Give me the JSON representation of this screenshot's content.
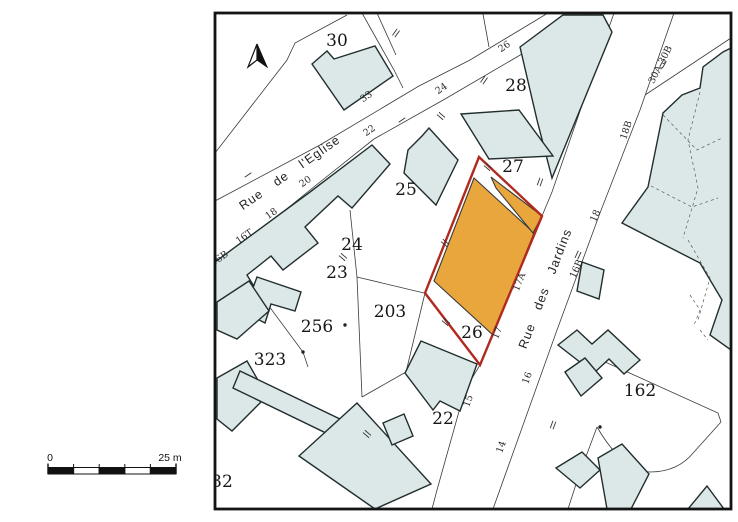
{
  "colors": {
    "highlight_outline": "#B02A20",
    "highlight_fill": "#E9A63C",
    "building_fill": "#DCE7E7"
  },
  "north_arrow": {
    "icon": "north-arrow"
  },
  "scale_bar": {
    "zero": "0",
    "max": "25 m"
  },
  "streets": {
    "eglise": "Rue de l'Eglise",
    "jardins": "Rue des Jardins"
  },
  "parcels": {
    "p30": "30",
    "p28": "28",
    "p27": "27",
    "p25": "25",
    "p24": "24",
    "p23": "23",
    "p256": "256",
    "p323": "323",
    "p203": "203",
    "p26": "26",
    "p22": "22",
    "p162": "162",
    "p32": "32"
  },
  "house_numbers": {
    "h33": "33",
    "h24": "24",
    "h26": "26",
    "h22": "22",
    "h20": "20",
    "h18": "18",
    "h16t": "16T",
    "h16b": "16B",
    "j17a": "17A",
    "j17": "17",
    "j15": "15",
    "j14": "14",
    "j16": "16",
    "j16b": "16B",
    "j18": "18",
    "j18b": "18B",
    "j30ab": "30A 30B"
  }
}
